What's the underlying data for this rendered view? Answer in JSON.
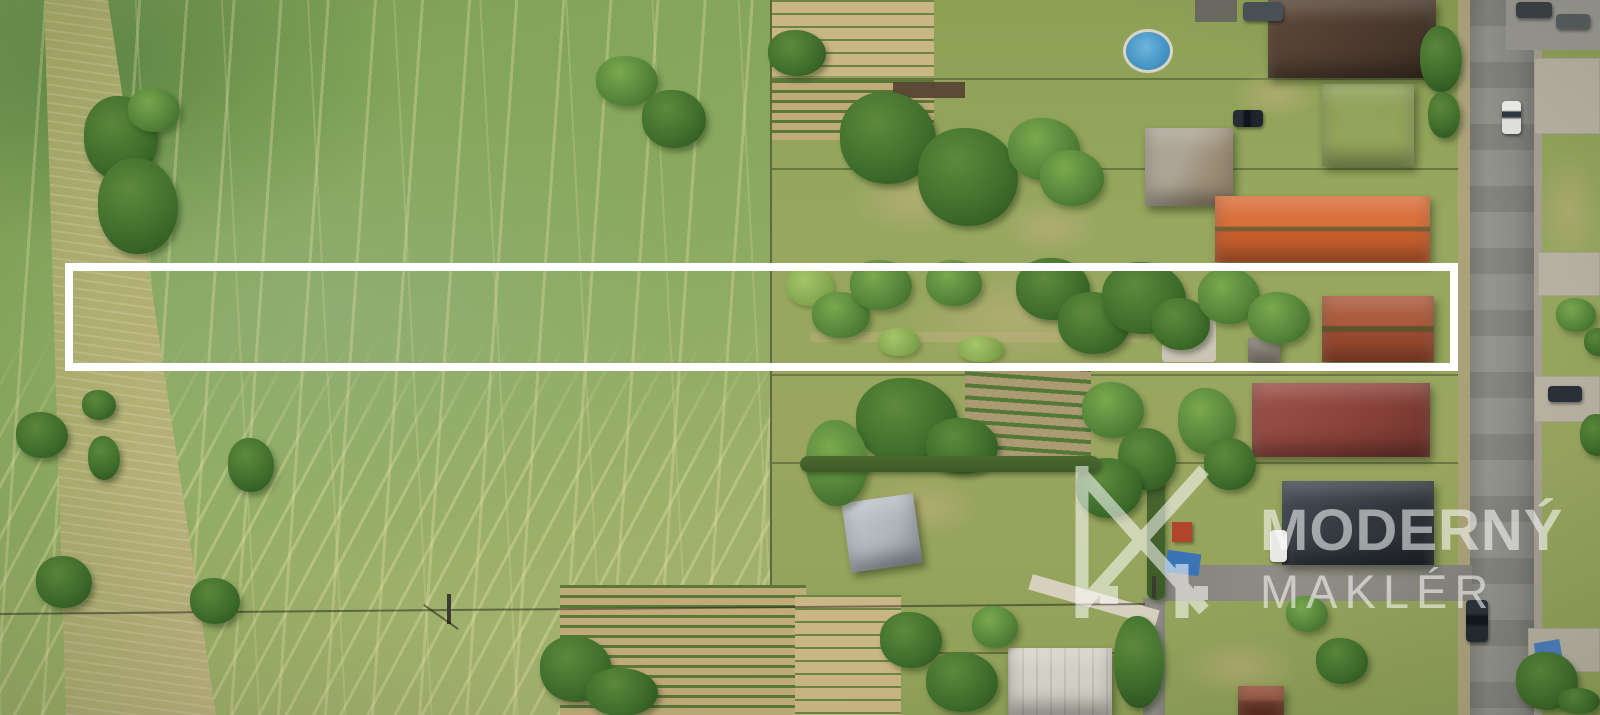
{
  "photo": {
    "kind": "aerial-drone-photograph",
    "description": "Top-down aerial drone photo of a long narrow building plot for sale: green crop field on the left, village gardens, sheds and houses with orange, red, brown and charcoal roofs on the right, a vertical asphalt road along the right edge with cars, and a white rectangle outlining the offered strip of land. Semi-transparent real-estate watermark in the lower right."
  },
  "overlay": {
    "plot_outline": {
      "shape": "rectangle",
      "x": 65,
      "y": 263,
      "width": 1393,
      "height": 108,
      "stroke_color": "#ffffff",
      "stroke_width": 8
    },
    "watermark": {
      "brand_line1": "MODERNÝ",
      "brand_line2": "MAKLÉR",
      "logo": "mm-monogram-icon",
      "color": "#ffffff",
      "opacity": 0.55
    }
  },
  "palette": {
    "field_green": "#7ea157",
    "dry_grass": "#a9b273",
    "dirt_path": "#c6b586",
    "village_grass": "#97a75f",
    "tree_green": "#40702c",
    "road_asphalt": "#8e8e88",
    "concrete": "#b9b3a4",
    "roof_dark_brown": "#4e3b2f",
    "roof_orange": "#c75f2e",
    "roof_rust_red": "#9a4a2f",
    "roof_red": "#8a423a",
    "roof_charcoal": "#31373d",
    "metal_roof": "#aeb6bb",
    "pool_blue": "#3e8fc0",
    "outline_white": "#ffffff"
  }
}
